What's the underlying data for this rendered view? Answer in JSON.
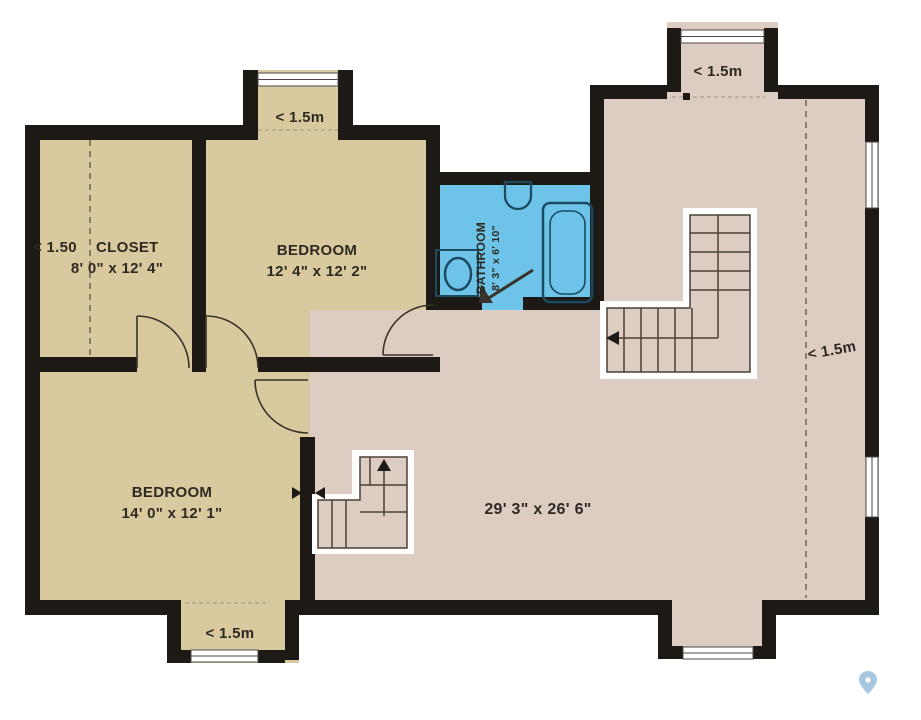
{
  "plan_title": "Upper floor plan",
  "rooms": {
    "closet": {
      "name": "CLOSET",
      "dims": "8' 0\" x 12' 4\""
    },
    "bedroom_top": {
      "name": "BEDROOM",
      "dims": "12' 4\" x 12' 2\""
    },
    "bedroom_bottom": {
      "name": "BEDROOM",
      "dims": "14' 0\" x 12' 1\""
    },
    "bathroom": {
      "name": "BATHROOM",
      "dims": "8' 3\" x 6' 10\""
    },
    "main": {
      "dims": "29' 3\" x 26' 6\""
    }
  },
  "labels": {
    "closet_ceiling": "< 1.50",
    "bay_top_left": "< 1.5m",
    "bay_top_right": "< 1.5m",
    "bay_bottom": "< 1.5m",
    "right_side": "< 1.5m"
  },
  "colors": {
    "floor_tan": "#d9c99e",
    "floor_main": "#ddccc1",
    "floor_bath": "#6ec4e8",
    "wall": "#1d1a16",
    "window_frame": "#4a4a4a",
    "window_fill": "#ffffff",
    "stair_border": "#ffffff",
    "stair_line": "#4a4036",
    "door_line": "#3a332b",
    "fixture": "#1c4a60",
    "dash_dark": "#6b6257",
    "dash_light": "#a99f92",
    "text": "#2e2a22",
    "pin": "#8ab5d6"
  }
}
